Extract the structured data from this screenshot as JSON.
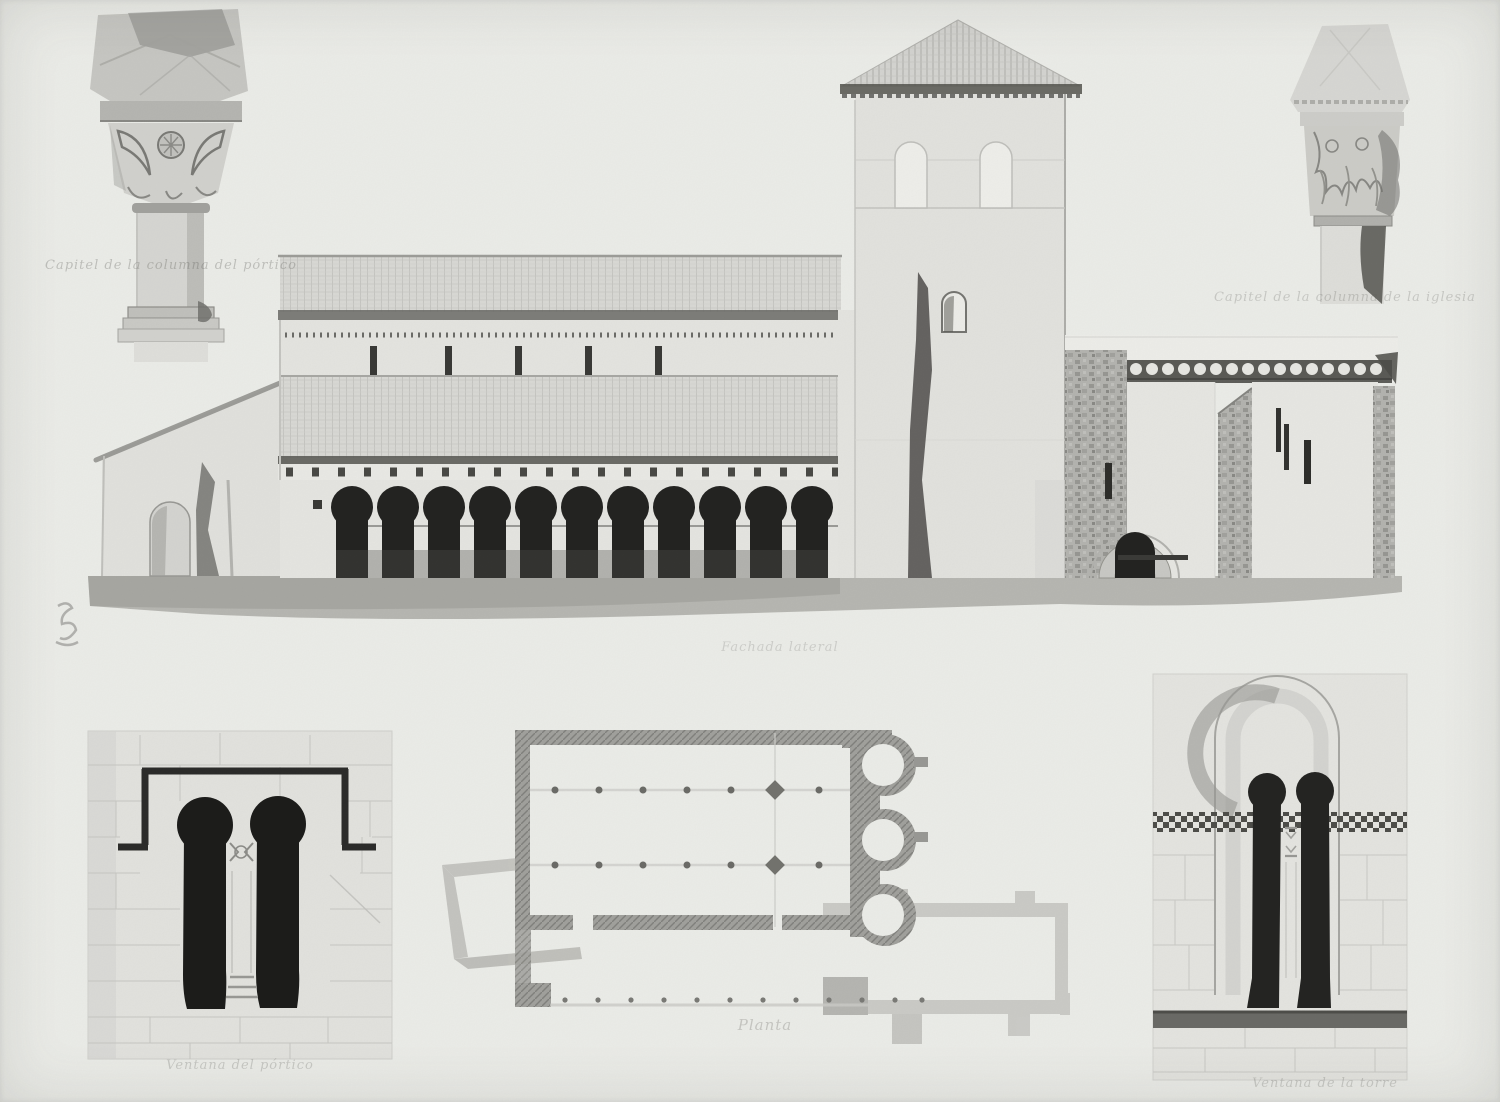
{
  "plate": {
    "captions": {
      "capital_left": "Capitel de la columna del pórtico",
      "capital_right": "Capitel de la columna de la iglesia",
      "elevation": "Fachada lateral",
      "window_left": "Ventana del pórtico",
      "plan": "Planta",
      "window_right": "Ventana de la torre"
    },
    "colors": {
      "paper": "#edeeea",
      "ink_black": "#1c1c1a",
      "ink_dark": "#4e4e4a",
      "ink_mid": "#9c9c98",
      "ink_light": "#cfcfcb"
    }
  }
}
